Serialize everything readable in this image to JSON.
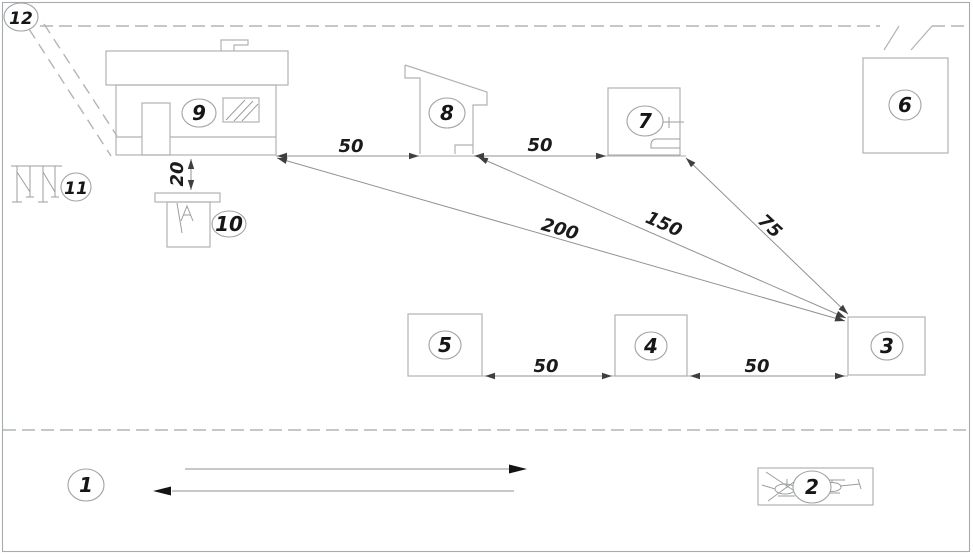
{
  "callouts": {
    "n1": "1",
    "n2": "2",
    "n3": "3",
    "n4": "4",
    "n5": "5",
    "n6": "6",
    "n7": "7",
    "n8": "8",
    "n9": "9",
    "n10": "10",
    "n11": "11",
    "n12": "12"
  },
  "dimensions": {
    "top_span_left": "50",
    "top_span_right": "50",
    "offset_9_to_10": "20",
    "diag_from_9": "200",
    "diag_from_8": "150",
    "diag_from_7": "75",
    "bottom_span_left": "50",
    "bottom_span_right": "50"
  },
  "colors": {
    "background": "#ffffff",
    "structure_line": "#b0b3b5",
    "boundary_dash": "#b2b5b7",
    "dimension_line": "#8f9294",
    "label_text": "#161616",
    "arrow_fill": "#141414"
  }
}
